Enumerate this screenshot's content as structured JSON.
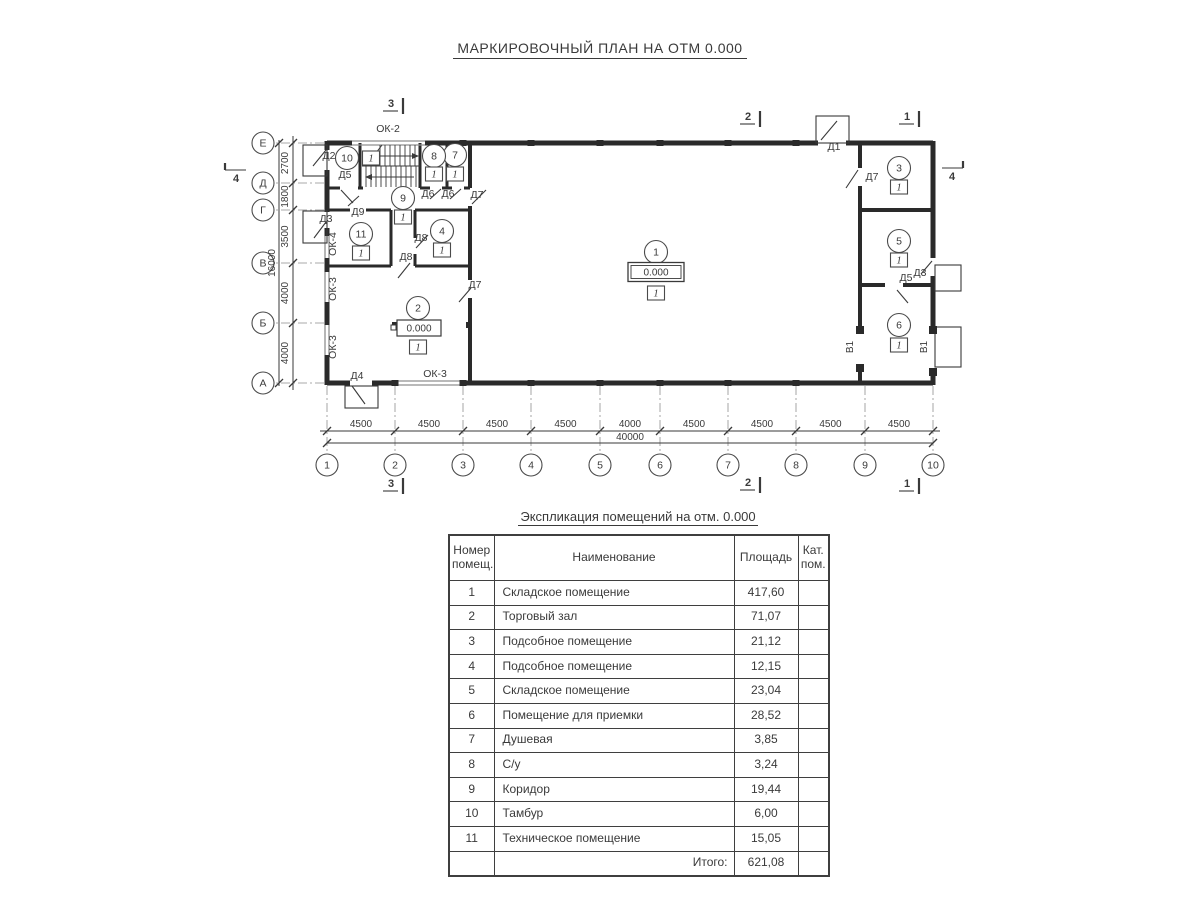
{
  "page_title": "МАРКИРОВОЧНЫЙ ПЛАН НА ОТМ 0.000",
  "plan": {
    "axes_bottom": [
      {
        "label": "1",
        "x": 327
      },
      {
        "label": "2",
        "x": 395
      },
      {
        "label": "3",
        "x": 463
      },
      {
        "label": "4",
        "x": 531
      },
      {
        "label": "5",
        "x": 600
      },
      {
        "label": "6",
        "x": 660
      },
      {
        "label": "7",
        "x": 728
      },
      {
        "label": "8",
        "x": 796
      },
      {
        "label": "9",
        "x": 865
      },
      {
        "label": "10",
        "x": 933
      }
    ],
    "axes_left": [
      {
        "label": "Е",
        "y": 143
      },
      {
        "label": "Д",
        "y": 183
      },
      {
        "label": "Г",
        "y": 210
      },
      {
        "label": "В",
        "y": 263
      },
      {
        "label": "Б",
        "y": 323
      },
      {
        "label": "А",
        "y": 383
      }
    ],
    "dims_bottom": {
      "segments": [
        "4500",
        "4500",
        "4500",
        "4500",
        "4000",
        "4500",
        "4500",
        "4500",
        "4500"
      ],
      "total": "40000"
    },
    "dims_left": {
      "segments": [
        "2700",
        "1800",
        "3500",
        "4000",
        "4000"
      ],
      "total": "16000"
    },
    "rooms": [
      {
        "number": "1",
        "x": 656,
        "y": 252,
        "cat": "1",
        "cat_x": 656,
        "cat_y": 293,
        "elevation": "0.000",
        "elev_x": 656,
        "elev_y": 272,
        "elev_style": "double"
      },
      {
        "number": "2",
        "x": 418,
        "y": 308,
        "cat": "1",
        "cat_x": 418,
        "cat_y": 347,
        "elevation": "0.000",
        "elev_x": 419,
        "elev_y": 328,
        "elev_style": "leader"
      },
      {
        "number": "3",
        "x": 899,
        "y": 168,
        "cat": "1",
        "cat_x": 899,
        "cat_y": 187
      },
      {
        "number": "4",
        "x": 442,
        "y": 231,
        "cat": "1",
        "cat_x": 442,
        "cat_y": 250
      },
      {
        "number": "5",
        "x": 899,
        "y": 241,
        "cat": "1",
        "cat_x": 899,
        "cat_y": 260
      },
      {
        "number": "6",
        "x": 899,
        "y": 325,
        "cat": "1",
        "cat_x": 899,
        "cat_y": 345
      },
      {
        "number": "7",
        "x": 455,
        "y": 155,
        "cat": "1",
        "cat_x": 455,
        "cat_y": 174
      },
      {
        "number": "8",
        "x": 434,
        "y": 156,
        "cat": "1",
        "cat_x": 434,
        "cat_y": 174
      },
      {
        "number": "9",
        "x": 403,
        "y": 198,
        "cat": "1",
        "cat_x": 403,
        "cat_y": 217
      },
      {
        "number": "10",
        "x": 347,
        "y": 158,
        "cat": "1",
        "cat_x": 371,
        "cat_y": 158
      },
      {
        "number": "11",
        "x": 361,
        "y": 234,
        "cat": "1",
        "cat_x": 361,
        "cat_y": 253
      }
    ],
    "door_labels": [
      {
        "text": "Д2",
        "x": 329,
        "y": 159
      },
      {
        "text": "Д5",
        "x": 345,
        "y": 178
      },
      {
        "text": "Д9",
        "x": 358,
        "y": 215
      },
      {
        "text": "Д3",
        "x": 326,
        "y": 222
      },
      {
        "text": "Д6",
        "x": 428,
        "y": 197
      },
      {
        "text": "Д6",
        "x": 448,
        "y": 197
      },
      {
        "text": "Д7",
        "x": 477,
        "y": 198
      },
      {
        "text": "Д8",
        "x": 421,
        "y": 241
      },
      {
        "text": "Д8",
        "x": 406,
        "y": 260
      },
      {
        "text": "Д7",
        "x": 475,
        "y": 288
      },
      {
        "text": "Д4",
        "x": 357,
        "y": 379
      },
      {
        "text": "Д1",
        "x": 834,
        "y": 150
      },
      {
        "text": "Д7",
        "x": 872,
        "y": 180
      },
      {
        "text": "Д5",
        "x": 906,
        "y": 281
      },
      {
        "text": "Д3",
        "x": 920,
        "y": 276
      }
    ],
    "window_labels": [
      {
        "text": "ОК-2",
        "x": 388,
        "y": 132,
        "r": 0
      },
      {
        "text": "ОК-4",
        "x": 336,
        "y": 244,
        "r": -90
      },
      {
        "text": "ОК-3",
        "x": 336,
        "y": 289,
        "r": -90
      },
      {
        "text": "ОК-3",
        "x": 336,
        "y": 347,
        "r": -90
      },
      {
        "text": "ОК-3",
        "x": 435,
        "y": 377,
        "r": 0
      }
    ],
    "gate_labels": [
      {
        "text": "В1",
        "x": 853,
        "y": 347,
        "r": -90
      },
      {
        "text": "В1",
        "x": 927,
        "y": 347,
        "r": -90
      }
    ],
    "section_marks": [
      {
        "text": "3",
        "x": 391,
        "y": 107,
        "type": "h"
      },
      {
        "text": "2",
        "x": 748,
        "y": 120,
        "type": "h"
      },
      {
        "text": "1",
        "x": 907,
        "y": 120,
        "type": "h"
      },
      {
        "text": "3",
        "x": 391,
        "y": 487,
        "type": "h"
      },
      {
        "text": "2",
        "x": 748,
        "y": 486,
        "type": "h"
      },
      {
        "text": "1",
        "x": 907,
        "y": 487,
        "type": "h"
      },
      {
        "text": "4",
        "x": 236,
        "y": 182,
        "type": "vl"
      },
      {
        "text": "4",
        "x": 952,
        "y": 180,
        "type": "vr"
      }
    ]
  },
  "table": {
    "title": "Экспликация помещений на отм. 0.000",
    "headers": [
      "Номер помещ.",
      "Наименование",
      "Площадь",
      "Кат. пом."
    ],
    "rows": [
      {
        "num": "1",
        "name": "Складское помещение",
        "area": "417,60",
        "cat": ""
      },
      {
        "num": "2",
        "name": "Торговый зал",
        "area": "71,07",
        "cat": ""
      },
      {
        "num": "3",
        "name": "Подсобное помещение",
        "area": "21,12",
        "cat": ""
      },
      {
        "num": "4",
        "name": "Подсобное помещение",
        "area": "12,15",
        "cat": ""
      },
      {
        "num": "5",
        "name": "Складское помещение",
        "area": "23,04",
        "cat": ""
      },
      {
        "num": "6",
        "name": "Помещение для приемки",
        "area": "28,52",
        "cat": ""
      },
      {
        "num": "7",
        "name": "Душевая",
        "area": "3,85",
        "cat": ""
      },
      {
        "num": "8",
        "name": "С/у",
        "area": "3,24",
        "cat": ""
      },
      {
        "num": "9",
        "name": "Коридор",
        "area": "19,44",
        "cat": ""
      },
      {
        "num": "10",
        "name": "Тамбур",
        "area": "6,00",
        "cat": ""
      },
      {
        "num": "11",
        "name": "Техническое помещение",
        "area": "15,05",
        "cat": ""
      }
    ],
    "total_label": "Итого:",
    "total_value": "621,08"
  }
}
